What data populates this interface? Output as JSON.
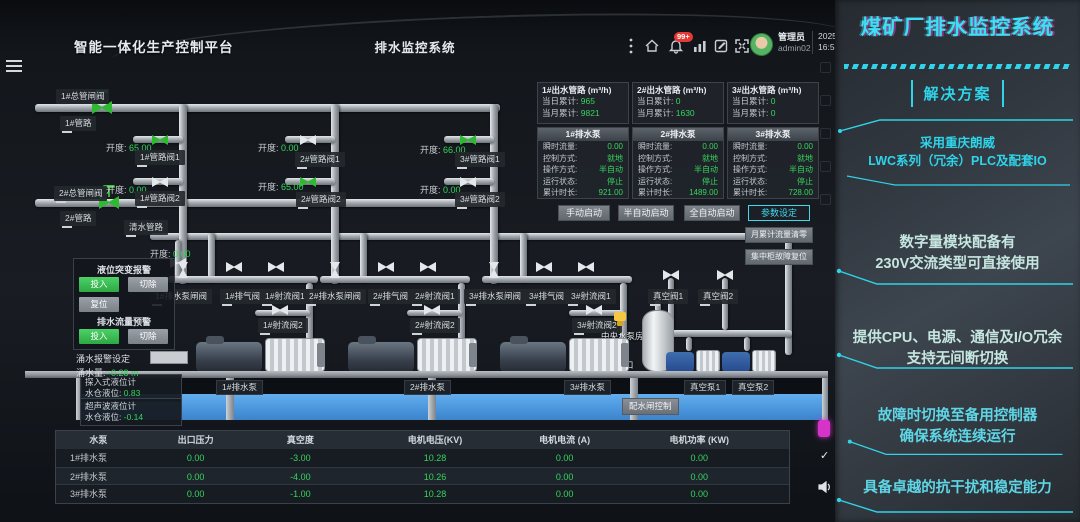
{
  "header": {
    "platform_title": "智能一体化生产控制平台",
    "system_title": "排水监控系统",
    "notification_badge": "99+",
    "user_role": "管理员",
    "user_id": "admin02",
    "date": "2025-02-28",
    "time": "16:57:43"
  },
  "outlets": [
    {
      "title": "1#出水管路 (m³/h)",
      "day_label": "当日累计:",
      "day_value": "965",
      "month_label": "当月累计:",
      "month_value": "9821"
    },
    {
      "title": "2#出水管路 (m³/h)",
      "day_label": "当日累计:",
      "day_value": "0",
      "month_label": "当月累计:",
      "month_value": "1630"
    },
    {
      "title": "3#出水管路 (m³/h)",
      "day_label": "当日累计:",
      "day_value": "0",
      "month_label": "当月累计:",
      "month_value": "0"
    }
  ],
  "pump_labels": {
    "flow": "瞬时流量:",
    "control": "控制方式:",
    "operation": "操作方式:",
    "status": "运行状态:",
    "hours": "累计时长:"
  },
  "pump_panels": [
    {
      "name": "1#排水泵",
      "flow": "0.00",
      "control": "就地",
      "operation": "半自动",
      "status": "停止",
      "hours": "921.00"
    },
    {
      "name": "2#排水泵",
      "flow": "0.00",
      "control": "就地",
      "operation": "半自动",
      "status": "停止",
      "hours": "1489.00"
    },
    {
      "name": "3#排水泵",
      "flow": "0.00",
      "control": "就地",
      "operation": "半自动",
      "status": "停止",
      "hours": "728.00"
    }
  ],
  "buttons": {
    "manual": "手动启动",
    "semi": "半自动启动",
    "auto": "全自动启动",
    "params": "参数设定",
    "reset_flow": "月累计流量清零",
    "reset_fault": "集中柜故障复位"
  },
  "alarm": {
    "level_title": "液位突变报警",
    "flow_title": "排水流量预警",
    "engage": "投入",
    "cut": "切除",
    "reset": "复位",
    "setting_label": "涌水报警设定",
    "setting_value": "",
    "inflow_label": "涌水量:",
    "inflow_value": "-0.28 m"
  },
  "diagram": {
    "opening_label": "开度:",
    "main_labels": [
      "1#总管闸阀",
      "1#管路",
      "2#总管闸阀",
      "2#管路",
      "清水管路"
    ],
    "line_valves": [
      {
        "name": "1#管路阀1",
        "opening": "65.00"
      },
      {
        "name": "1#管路阀2",
        "opening": "0.00"
      },
      {
        "name": "2#管路阀1",
        "opening": "0.00"
      },
      {
        "name": "2#管路阀2",
        "opening": "65.00"
      },
      {
        "name": "3#管路阀1",
        "opening": "66.00"
      },
      {
        "name": "3#管路阀2",
        "opening": "0.00"
      },
      {
        "name": "清水管路阀",
        "opening": "0.00"
      }
    ],
    "group_valves": [
      {
        "gate": "1#排水泵闸阀",
        "vent": "1#排气阀",
        "jet1": "1#射流阀1",
        "jet2": "1#射流阀2"
      },
      {
        "gate": "2#排水泵闸阀",
        "vent": "2#排气阀",
        "jet1": "2#射流阀1",
        "jet2": "2#射流阀2"
      },
      {
        "gate": "3#排水泵闸阀",
        "vent": "3#排气阀",
        "jet1": "3#射流阀1",
        "jet2": "3#射流阀2"
      }
    ],
    "vacuum_valves": [
      "真空阀1",
      "真空阀2"
    ],
    "room_label": "中央水泵房",
    "sump_label": "水仓口",
    "gauges": [
      {
        "name": "探入式液位计",
        "label": "水仓液位:",
        "value": "0.83"
      },
      {
        "name": "超声波液位计",
        "label": "水仓液位:",
        "value": "-0.14"
      }
    ],
    "basin_labels": [
      "1#排水泵",
      "2#排水泵",
      "3#排水泵",
      "真空泵1",
      "真空泵2"
    ],
    "basin_button": "配水闸控制"
  },
  "table": {
    "headers": [
      "水泵",
      "出口压力",
      "真空度",
      "电机电压(KV)",
      "电机电流 (A)",
      "电机功率 (KW)"
    ],
    "rows": [
      {
        "name": "1#排水泵",
        "values": [
          "0.00",
          "-3.00",
          "10.28",
          "0.00",
          "0.00"
        ]
      },
      {
        "name": "2#排水泵",
        "values": [
          "0.00",
          "-4.00",
          "10.26",
          "0.00",
          "0.00"
        ]
      },
      {
        "name": "3#排水泵",
        "values": [
          "0.00",
          "-1.00",
          "10.28",
          "0.00",
          "0.00"
        ]
      }
    ]
  },
  "promo": {
    "title": "煤矿厂排水监控系统",
    "tag": "解决方案",
    "item1_line1": "采用重庆朗威",
    "item1_line2": "LWC系列（冗余）PLC及配套IO",
    "item2_line1": "数字量模块配备有",
    "item2_line2": "230V交流类型可直接使用",
    "item3_line1": "提供CPU、电源、通信及I/O冗余",
    "item3_line2": "支持无间断切换",
    "item4_line1": "故障时切换至备用控制器",
    "item4_line2": "确保系统连续运行",
    "item5": "具备卓越的抗干扰和稳定能力"
  },
  "colors": {
    "accent_cyan": "#2fd4ea",
    "value_green": "#36d45c",
    "water_blue": "#4690d8",
    "badge_red": "#e53935",
    "magenta": "#d633c8"
  }
}
